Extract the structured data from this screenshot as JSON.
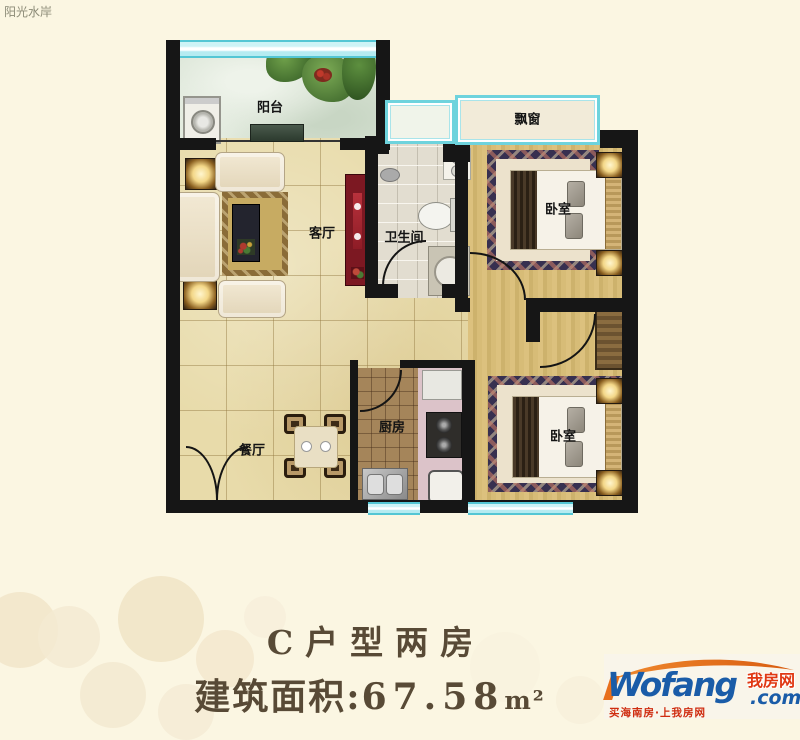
{
  "page": {
    "project_name": "阳光水岸",
    "background": "#fbf6e2"
  },
  "floorplan": {
    "rooms": {
      "balcony": "阳台",
      "living_room": "客厅",
      "bathroom": "卫生间",
      "bay_window": "飘窗",
      "bedroom_top": "卧室",
      "dining_room": "餐厅",
      "kitchen": "厨房",
      "bedroom_bottom": "卧室"
    },
    "colors": {
      "wall": "#161616",
      "window_glass": "#c6f0f4",
      "window_frame": "#54c6d4",
      "marble_floor": "#e8dbaa",
      "wood_floor": "#d5ba75",
      "kitchen_floor": "#a5855a",
      "bathroom_floor": "#e2ddd0",
      "balcony_floor": "#d8e3d4",
      "rug_border": "#373050",
      "tv_cabinet": "#7c1822"
    }
  },
  "caption": {
    "line1": "C户型两房",
    "area_label": "建筑面积:",
    "area_value": "67.58",
    "area_unit": "m²"
  },
  "logo": {
    "brand": "Wofang",
    "brand_cn": "我房网",
    "domain": ".com",
    "tagline": "买海南房·上我房网",
    "colors": {
      "blue": "#1a5ca8",
      "orange": "#e8701c",
      "red": "#d93413"
    }
  }
}
